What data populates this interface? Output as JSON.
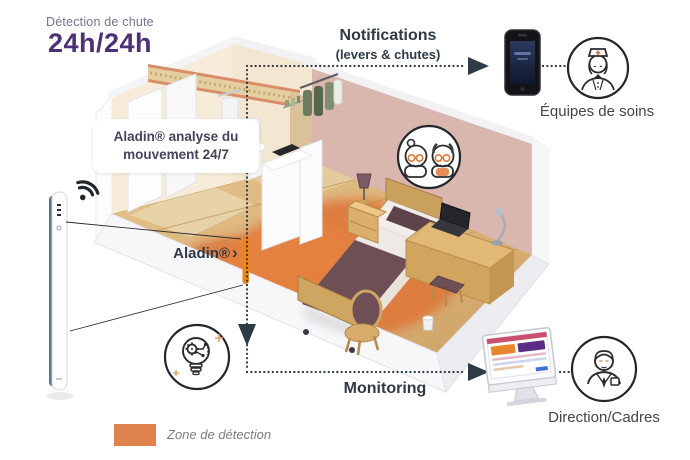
{
  "header": {
    "subtitle": "Détection de chute",
    "title": "24h/24h"
  },
  "sensor": {
    "note_line1": "Aladin® analyse du",
    "note_line2": "mouvement 24/7",
    "label": "Aladin®",
    "pointer": "›"
  },
  "flow_top": {
    "title": "Notifications",
    "subtitle": "(levers & chutes)",
    "recipient": "Équipes de soins"
  },
  "flow_bottom": {
    "title": "Monitoring",
    "recipient": "Direction/Cadres"
  },
  "legend": {
    "label": "Zone de détection",
    "swatch_color": "#e0824d"
  },
  "icons": {
    "wifi-icon": "wifi signal from sensor bar",
    "elderly-couple-icon": "monitored residents badge",
    "nurse-icon": "care team",
    "innovation-bulb-icon": "analysis / lightbulb with gear",
    "director-icon": "manager with badge",
    "smartphone-icon": "notification handset",
    "monitor-icon": "monitoring dashboard screen",
    "arrow-up-icon": "flow to notifications",
    "arrow-down-icon": "flow to monitoring",
    "arrow-right-icon": "flow direction"
  },
  "colors": {
    "title_purple": "#4d3076",
    "subtitle_gray_purple": "#7b718e",
    "line_dark": "#2e3a45",
    "accent_orange": "#ee8413",
    "zone_orange": "#e0763a",
    "wall_pink": "#d9b6ae",
    "device_teal": "#4e7b7e"
  }
}
